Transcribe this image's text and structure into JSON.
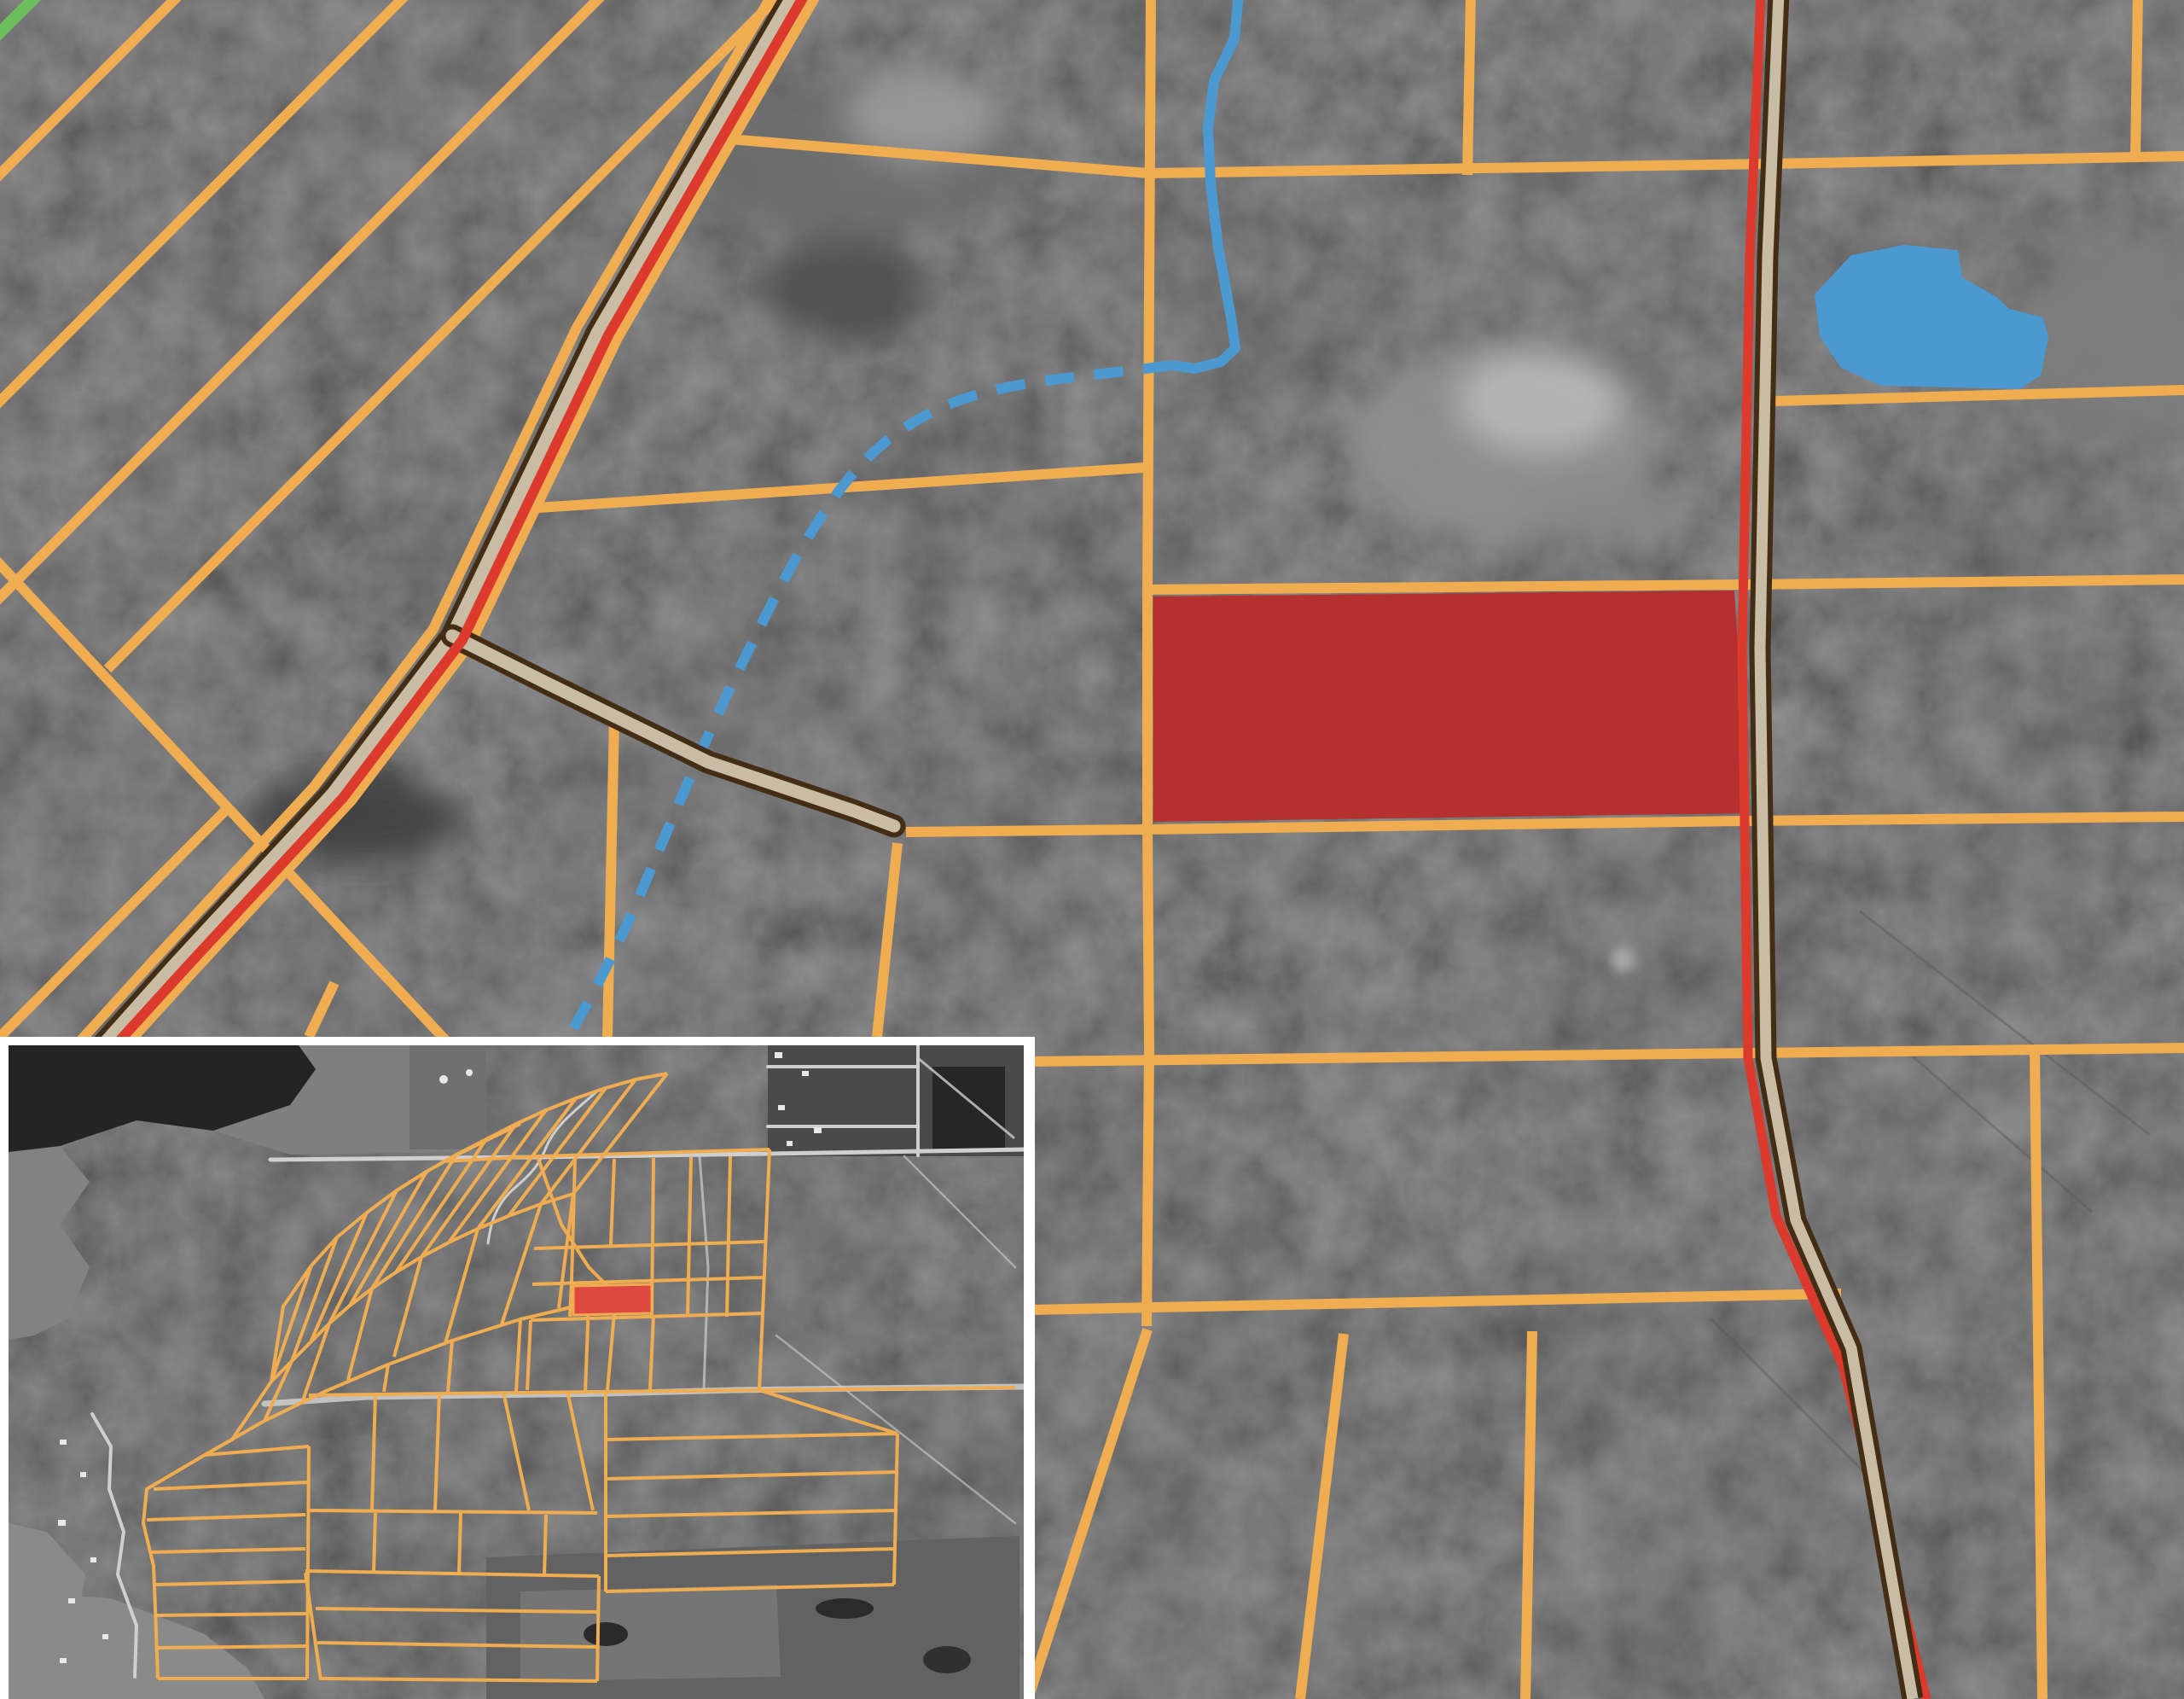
{
  "app": {
    "title": "Parcel boundary map over grayscale aerial imagery",
    "view": "GIS map viewer"
  },
  "colors": {
    "bg": "#232323",
    "parcel-orange": "#F0AC50",
    "road-fill": "#C9BCA4",
    "road-casing": "#432D15",
    "highway-red": "#DB3A2C",
    "parcel-red": "#B43130",
    "inset-red": "#DE4840",
    "water-blue": "#4C99D2",
    "boundary-green": "#6CBE5C",
    "inset-frame": "#FFFFFF"
  },
  "map": {
    "label": "Main parcel map with highlighted lot, roads, stream and lake",
    "layers": {
      "aerial": "dark grayscale forest imagery",
      "parcels": "orange parcel boundary lines",
      "highlight": "red highlighted parcel",
      "hydrology": "blue lake polygon and blue stream (solid and dashed)",
      "roads": "tan roads with dark brown casing and red highway overlay",
      "green_edge": "short green boundary segment at top-left corner"
    }
  },
  "inset": {
    "label": "Overview inset map with full parcel network and highlighted lot",
    "highlight_label": "Subject parcel location"
  }
}
